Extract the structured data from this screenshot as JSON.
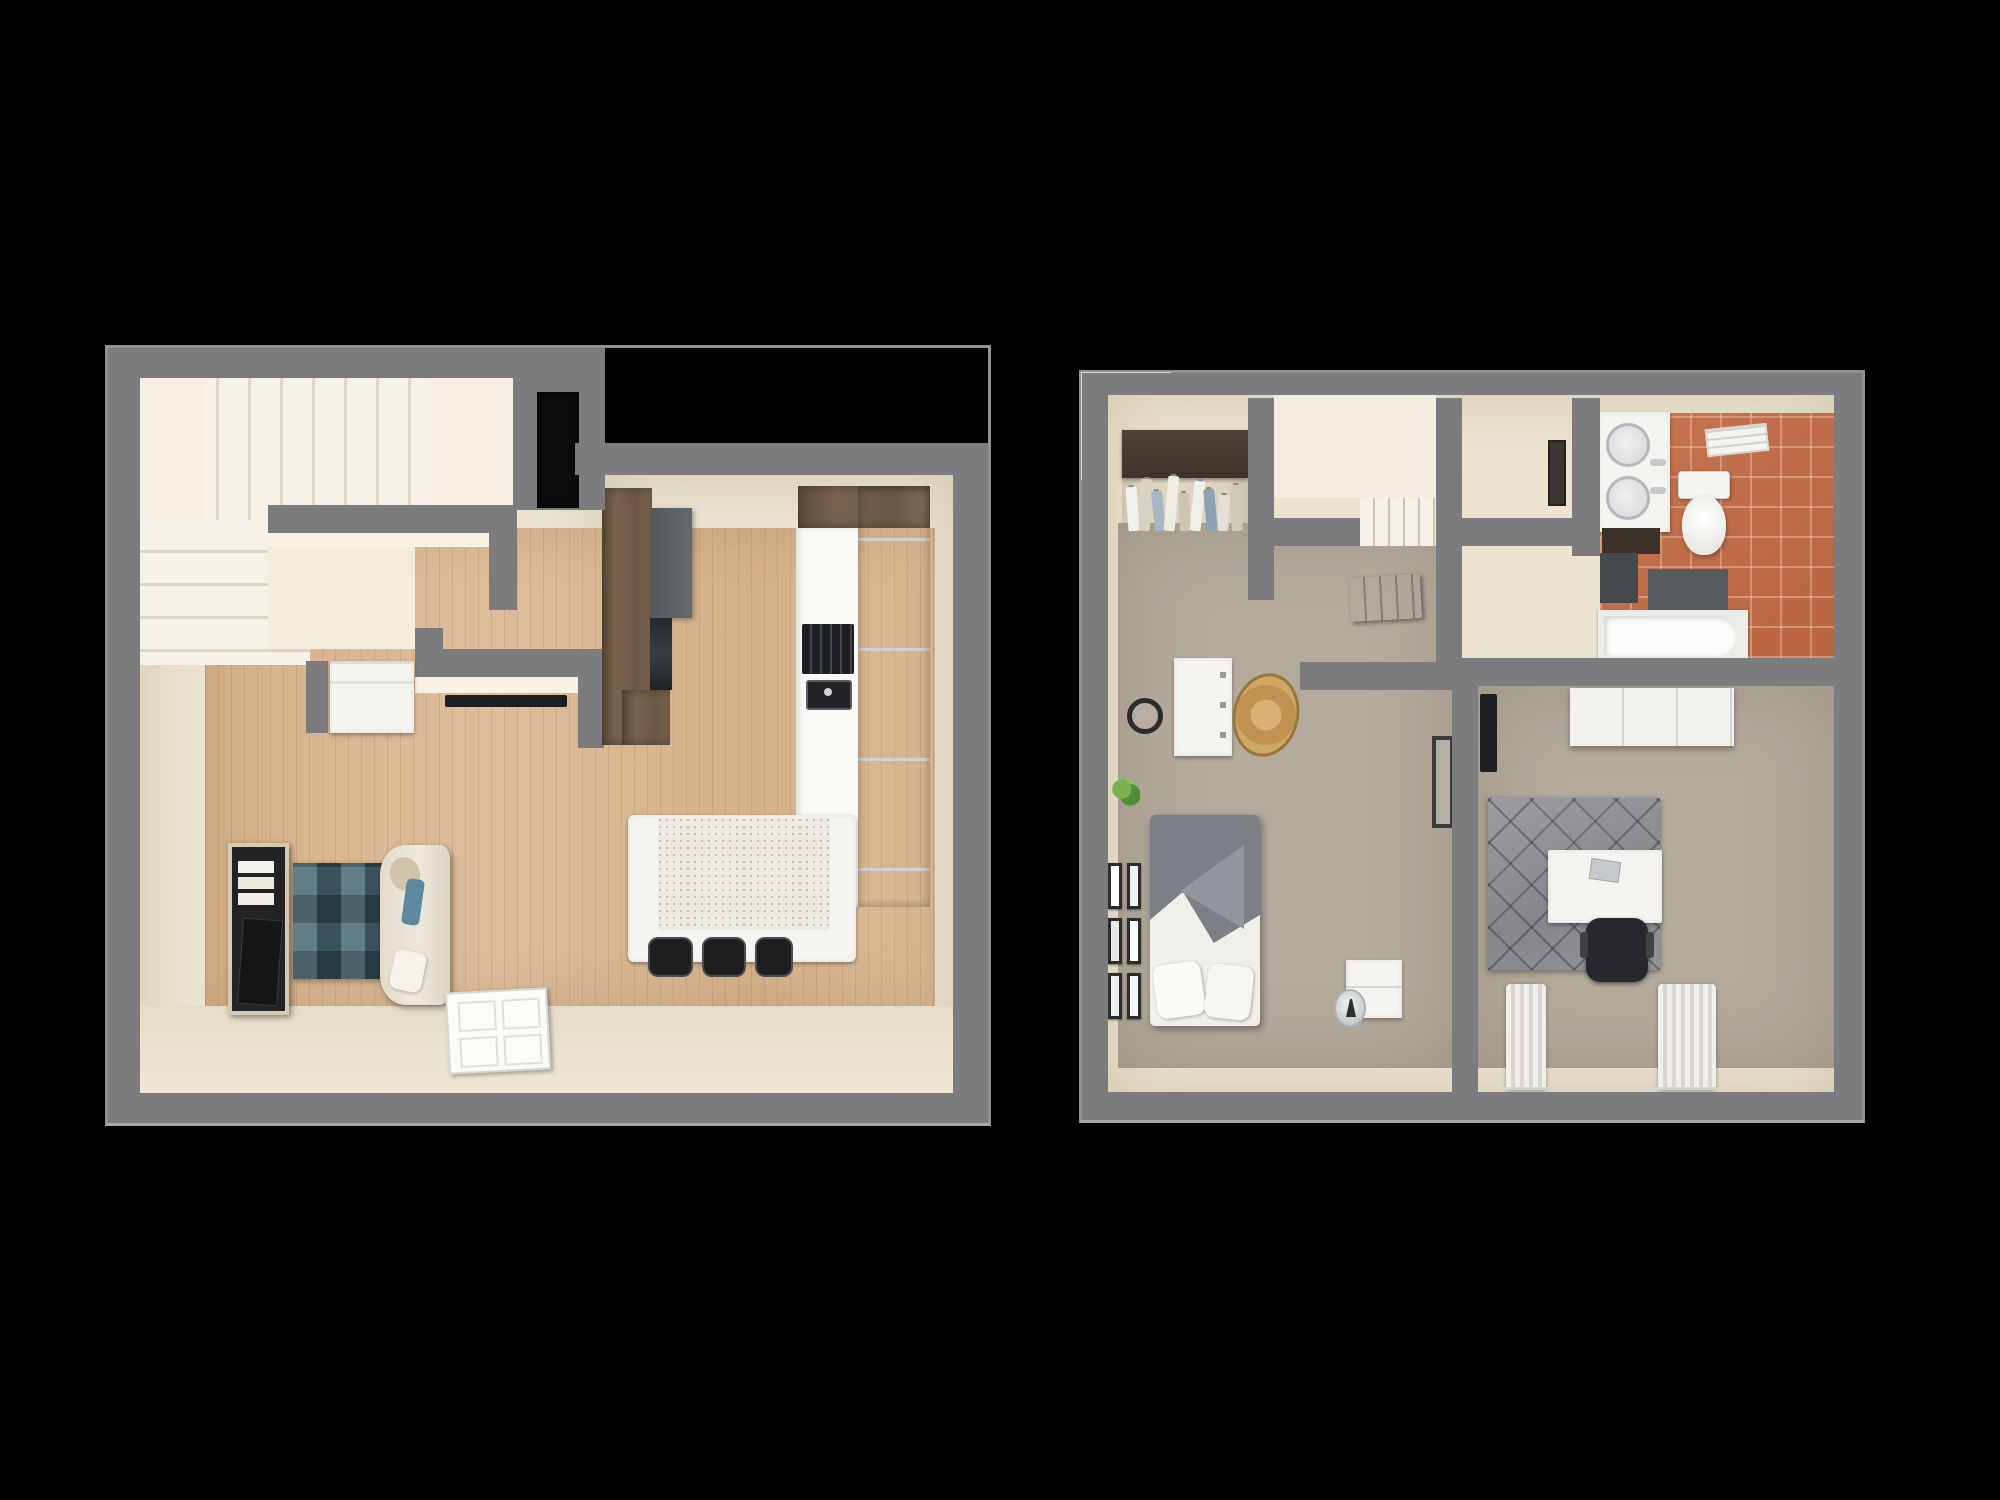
{
  "scene": {
    "type": "3d-floor-plan-rendering",
    "background": "#000000",
    "plans": [
      {
        "id": "first-floor",
        "rooms": [
          {
            "name": "entry-stair-hall",
            "items": [
              "l-winder-staircase",
              "black-entry-door",
              "under-stair-nook",
              "washer-cabinet",
              "wall-mounted-tv-strip"
            ]
          },
          {
            "name": "kitchen",
            "items": [
              "tall-wood-cabinet",
              "slate-wall-cabinet",
              "built-in-oven",
              "wood-cabinet-run",
              "white-countertop",
              "cooktop",
              "sink",
              "stone-top-island",
              "bar-stools"
            ]
          },
          {
            "name": "living-room",
            "items": [
              "tv-stand-with-books",
              "flatscreen-tv",
              "blue-patchwork-rug",
              "cream-loveseat",
              "throw-pillows",
              "open-white-door"
            ]
          }
        ]
      },
      {
        "id": "second-floor",
        "rooms": [
          {
            "name": "walk-in-closet",
            "items": [
              "clothes-rod",
              "hanging-clothes"
            ]
          },
          {
            "name": "stairwell",
            "items": [
              "descending-stairs"
            ]
          },
          {
            "name": "bathroom",
            "items": [
              "double-sink-vanity",
              "chrome-faucets",
              "dark-base-cabinet",
              "toilet",
              "towel-shelf",
              "bath-mats",
              "bathtub",
              "terracotta-tile-floor"
            ]
          },
          {
            "name": "hallway",
            "items": [
              "open-brown-door",
              "wall-frame"
            ]
          },
          {
            "name": "bedroom-primary",
            "items": [
              "white-dresser",
              "round-black-mirror",
              "jute-rug",
              "potted-plant",
              "bed-gray-white-bedding",
              "gallery-wall-frames",
              "nightstand",
              "glass-vase",
              "leaning-mirror",
              "window"
            ]
          },
          {
            "name": "bedroom-office",
            "items": [
              "white-wardrobe",
              "wall-tv",
              "gray-diamond-rug",
              "white-desk",
              "laptop",
              "black-office-chair",
              "window",
              "pooled-curtains"
            ]
          }
        ]
      }
    ]
  },
  "colors": {
    "background": "#000000",
    "wall_gray": "#7c7c7f",
    "wall_face_cream": "#f7f2e4",
    "floor_cream": "#ece4d1",
    "wood_floor": "#d8b690",
    "stair_tread": "#f5f1e6",
    "cabinet_wood": "#6f5c48",
    "cabinet_slate": "#5c6165",
    "counter_white": "#fafaf7",
    "island_stone": "#e7e4da",
    "appliance_dark": "#1f2022",
    "sofa_cream": "#eae3d5",
    "rug_blue": "#41606d",
    "rug_gray": "#8f9195",
    "carpet_taupe": "#b4ab9d",
    "bath_tile_terracotta": "#bf6f4e",
    "fixture_white": "#f6f6f3",
    "door_brown": "#57463a",
    "entry_door_black": "#0b0b0c",
    "rug_jute": "#c9a766",
    "blanket_gray": "#7c7f85"
  },
  "closet": {
    "clothes": [
      {
        "color": "#f3f1eb",
        "h": 44,
        "tilt": -4
      },
      {
        "color": "#d9d2c3",
        "h": 52,
        "tilt": 3
      },
      {
        "color": "#a6b8c6",
        "h": 40,
        "tilt": -6
      },
      {
        "color": "#efece2",
        "h": 55,
        "tilt": 5
      },
      {
        "color": "#cdc5b4",
        "h": 38,
        "tilt": -3
      },
      {
        "color": "#f1efe7",
        "h": 50,
        "tilt": 6
      },
      {
        "color": "#8da1b3",
        "h": 42,
        "tilt": -5
      },
      {
        "color": "#e5e0d3",
        "h": 36,
        "tilt": 2
      },
      {
        "color": "#d0c8b9",
        "h": 46,
        "tilt": -2
      }
    ]
  },
  "gallery": {
    "frames": [
      {
        "color": "#ffffff"
      },
      {
        "color": "#f2f2f2"
      },
      {
        "color": "#e9e9e9"
      },
      {
        "color": "#ffffff"
      },
      {
        "color": "#ededed"
      },
      {
        "color": "#f7f7f7"
      }
    ]
  },
  "island": {
    "stools": [
      {
        "color": "#1d1e20",
        "w": 45
      },
      {
        "color": "#1d1e20",
        "w": 44
      },
      {
        "color": "#1d1e20",
        "w": 38
      }
    ]
  }
}
